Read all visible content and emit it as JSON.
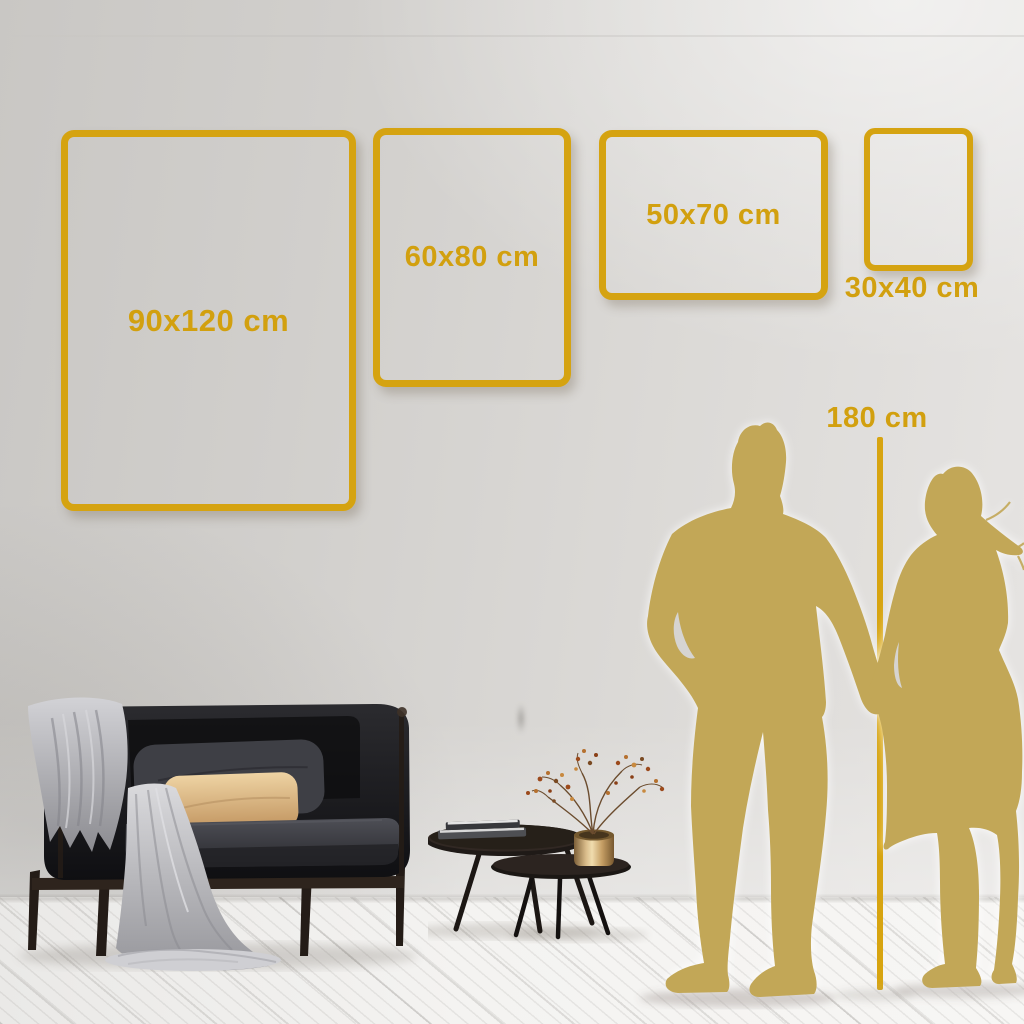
{
  "title": "Wall art size guide mockup",
  "size_frames": [
    {
      "label": "90x120 cm",
      "orientation": "portrait"
    },
    {
      "label": "60x80 cm",
      "orientation": "portrait"
    },
    {
      "label": "50x70 cm",
      "orientation": "landscape"
    },
    {
      "label": "30x40 cm",
      "orientation": "portrait"
    }
  ],
  "height_reference": {
    "label": "180 cm"
  },
  "colors": {
    "accent_gold": "#d5a311",
    "silhouette_khaki": "#c2a757",
    "wall_left": "#c9c7c4",
    "wall_right": "#e6e4e2",
    "floor": "#f4f3f1",
    "sofa_dark": "#1a1a1d",
    "pillow_tan": "#d9b284",
    "blanket_grey": "#b4b4b8",
    "vase_brass": "#d9bc8a"
  },
  "scene_objects": {
    "sofa": "dark loveseat with grey throw blanket, dark pillow and tan lumbar pillow",
    "tables": "two nesting round coffee tables with books and brass vase with dried branches",
    "people": "man and woman silhouettes holding hands"
  }
}
